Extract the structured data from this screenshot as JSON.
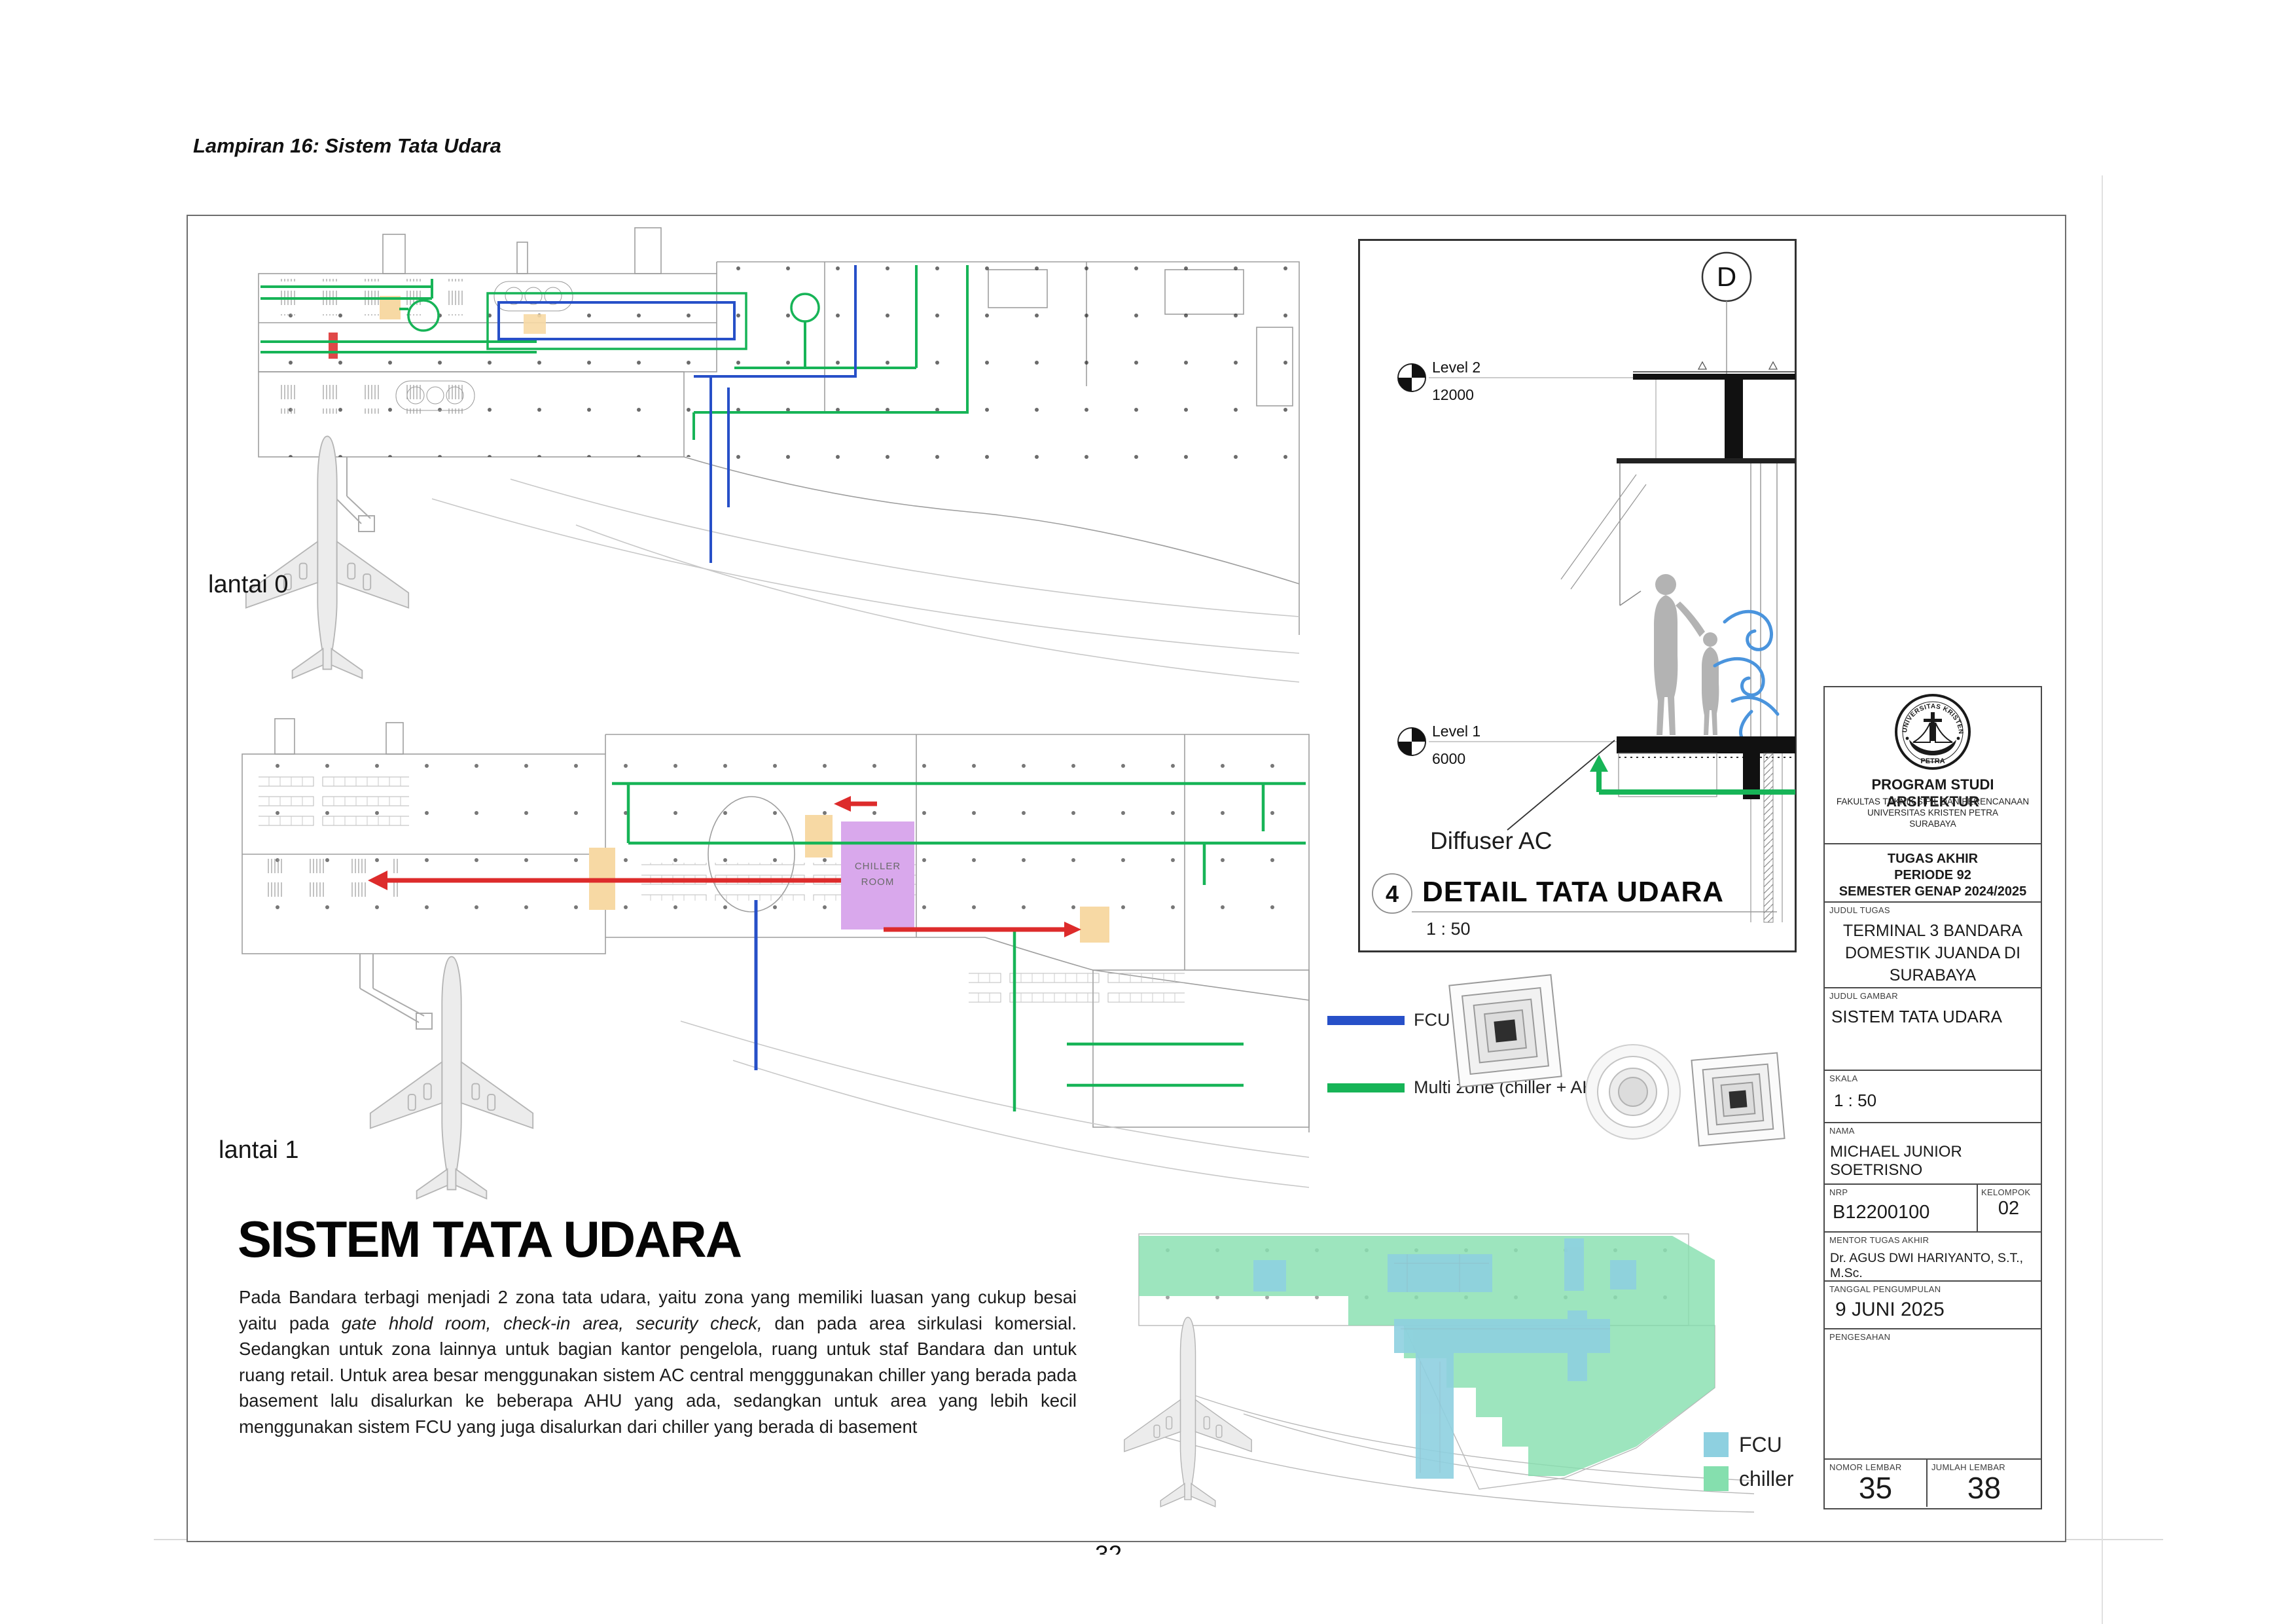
{
  "page": {
    "lampiran_title": "Lampiran 16: Sistem Tata Udara",
    "page_number": "32"
  },
  "plans": {
    "lantai0_label": "lantai 0",
    "lantai1_label": "lantai 1",
    "chiller_room_line1": "CHILLER",
    "chiller_room_line2": "ROOM"
  },
  "detail": {
    "marker": "D",
    "level2_label": "Level 2",
    "level2_elevation": "12000",
    "level1_label": "Level 1",
    "level1_elevation": "6000",
    "diffuser_label": "Diffuser AC",
    "number": "4",
    "title": "DETAIL TATA UDARA",
    "scale": "1 : 50"
  },
  "duct_legend": {
    "fcu_label": "FCU",
    "fcu_color": "#2750c8",
    "multizone_label": "Multi zone (chiller + AHU)",
    "multizone_color": "#17b457"
  },
  "zone_legend": {
    "fcu_label": "FCU",
    "fcu_color": "#8ed0e0",
    "chiller_label": "chiller",
    "chiller_color": "#85dfae"
  },
  "description": {
    "heading": "SISTEM TATA UDARA",
    "body_part1": "Pada Bandara terbagi menjadi 2  zona tata udara, yaitu zona yang memiliki luasan yang cukup besai yaitu pada ",
    "body_italic": "gate hhold room, check-in area, security check,",
    "body_part2": " dan pada area sirkulasi komersial. Sedangkan untuk zona lainnya untuk bagian kantor pengelola, ruang untuk staf Bandara dan untuk ruang retail. Untuk area besar menggunakan sistem AC central mengggunakan chiller yang berada pada basement lalu disalurkan ke beberapa AHU yang ada, sedangkan untuk area yang lebih kecil menggunakan sistem FCU yang juga disalurkan dari chiller yang berada di basement"
  },
  "title_block": {
    "logo_icon": "universitas-kristen-petra-logo",
    "logo_arc_top": "UNIVERSITAS KRISTEN",
    "logo_name": "PETRA",
    "program": "PROGRAM STUDI ARSITEKTUR",
    "faculty": "FAKULTAS TEKNIK SIPIL DAN PERENCANAAN",
    "university": "UNIVERSITAS KRISTEN PETRA",
    "city": "SURABAYA",
    "tugas_akhir": "TUGAS AKHIR",
    "periode": "PERIODE 92",
    "semester": "SEMESTER GENAP 2024/2025",
    "judul_tugas_label": "JUDUL TUGAS",
    "judul_tugas": "TERMINAL 3 BANDARA DOMESTIK JUANDA DI SURABAYA",
    "judul_gambar_label": "JUDUL GAMBAR",
    "judul_gambar": "SISTEM TATA UDARA",
    "skala_label": "SKALA",
    "skala": "1 : 50",
    "nama_label": "NAMA",
    "nama": "MICHAEL JUNIOR SOETRISNO",
    "nrp_label": "NRP",
    "nrp": "B12200100",
    "kelompok_label": "KELOMPOK",
    "kelompok": "02",
    "mentor_label": "MENTOR TUGAS AKHIR",
    "mentor": "Dr. AGUS DWI HARIYANTO, S.T., M.Sc.",
    "tanggal_label": "TANGGAL PENGUMPULAN",
    "tanggal": "9 JUNI  2025",
    "pengesahan_label": "PENGESAHAN",
    "nomor_lembar_label": "NOMOR LEMBAR",
    "nomor_lembar": "35",
    "jumlah_lembar_label": "JUMLAH LEMBAR",
    "jumlah_lembar": "38"
  }
}
